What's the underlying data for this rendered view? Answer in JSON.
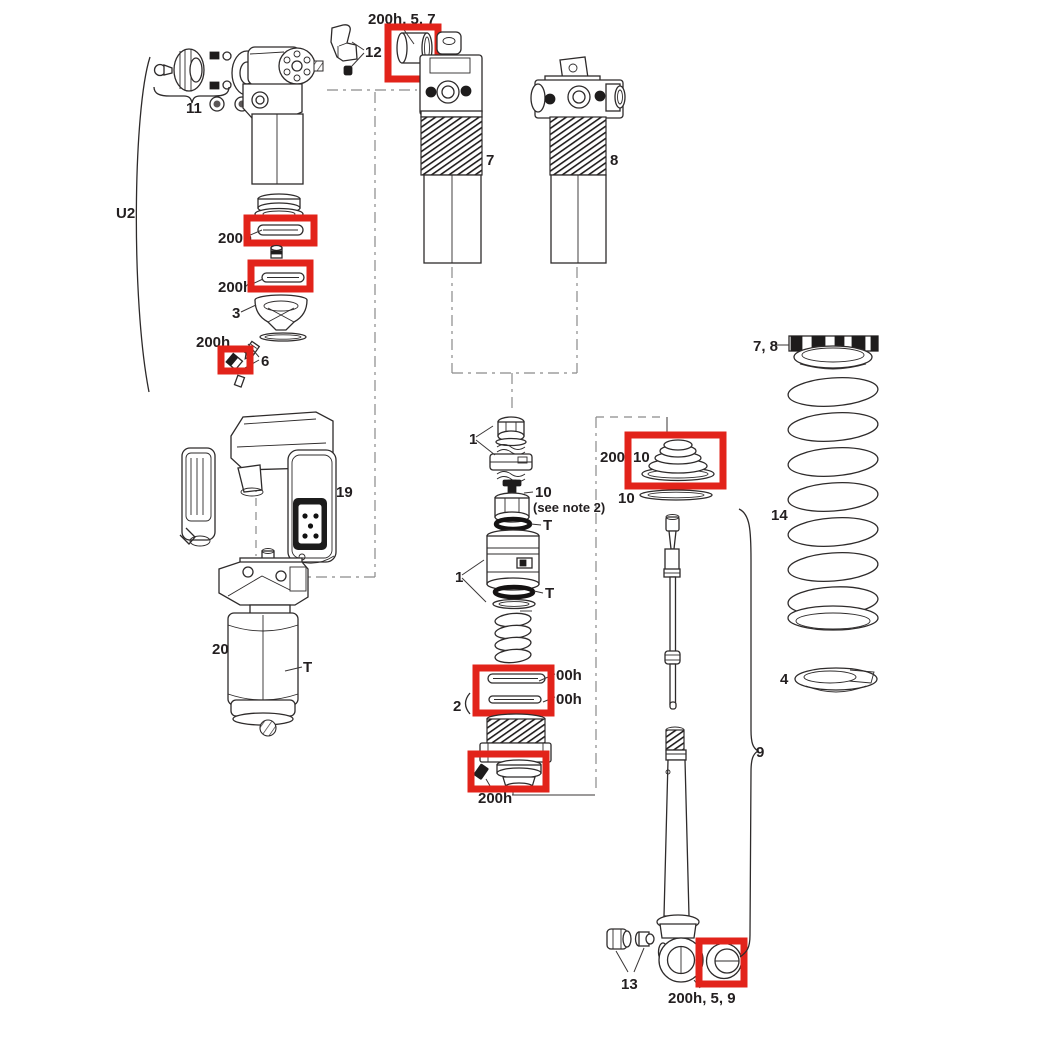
{
  "figure": {
    "type": "exploded-parts-diagram",
    "subject": "rear shock exploded service view",
    "highlight_color": "#e2231a",
    "ink_color": "#2e2b2b",
    "background": "#ffffff"
  },
  "labels": {
    "group_u2": "U2",
    "part_11": "11",
    "part_12": "12",
    "bushing_top": "200h, 5, 7",
    "seal_upper": "200h",
    "seal_lower": "200h",
    "part_3": "3",
    "screw_seal": "200h",
    "part_6": "6",
    "part_7": "7",
    "part_8": "8",
    "part_1_upper": "1",
    "part_10": "10",
    "part_10_note": "(see note 2)",
    "t_upper": "T",
    "part_1_lower": "1",
    "t_lower": "T",
    "part_2": "2",
    "seal_stack_upper": "00h",
    "seal_stack_lower": "00h",
    "seal_head": "200h",
    "wiper_prefix": "200",
    "wiper_10": "10",
    "washer_10": "10",
    "preload_ring": "7, 8",
    "part_14": "14",
    "part_4": "4",
    "part_9": "9",
    "part_13": "13",
    "bushing_bottom": "200h, 5, 9",
    "part_19": "19",
    "part_20": "20",
    "t_reservoir": "T"
  }
}
